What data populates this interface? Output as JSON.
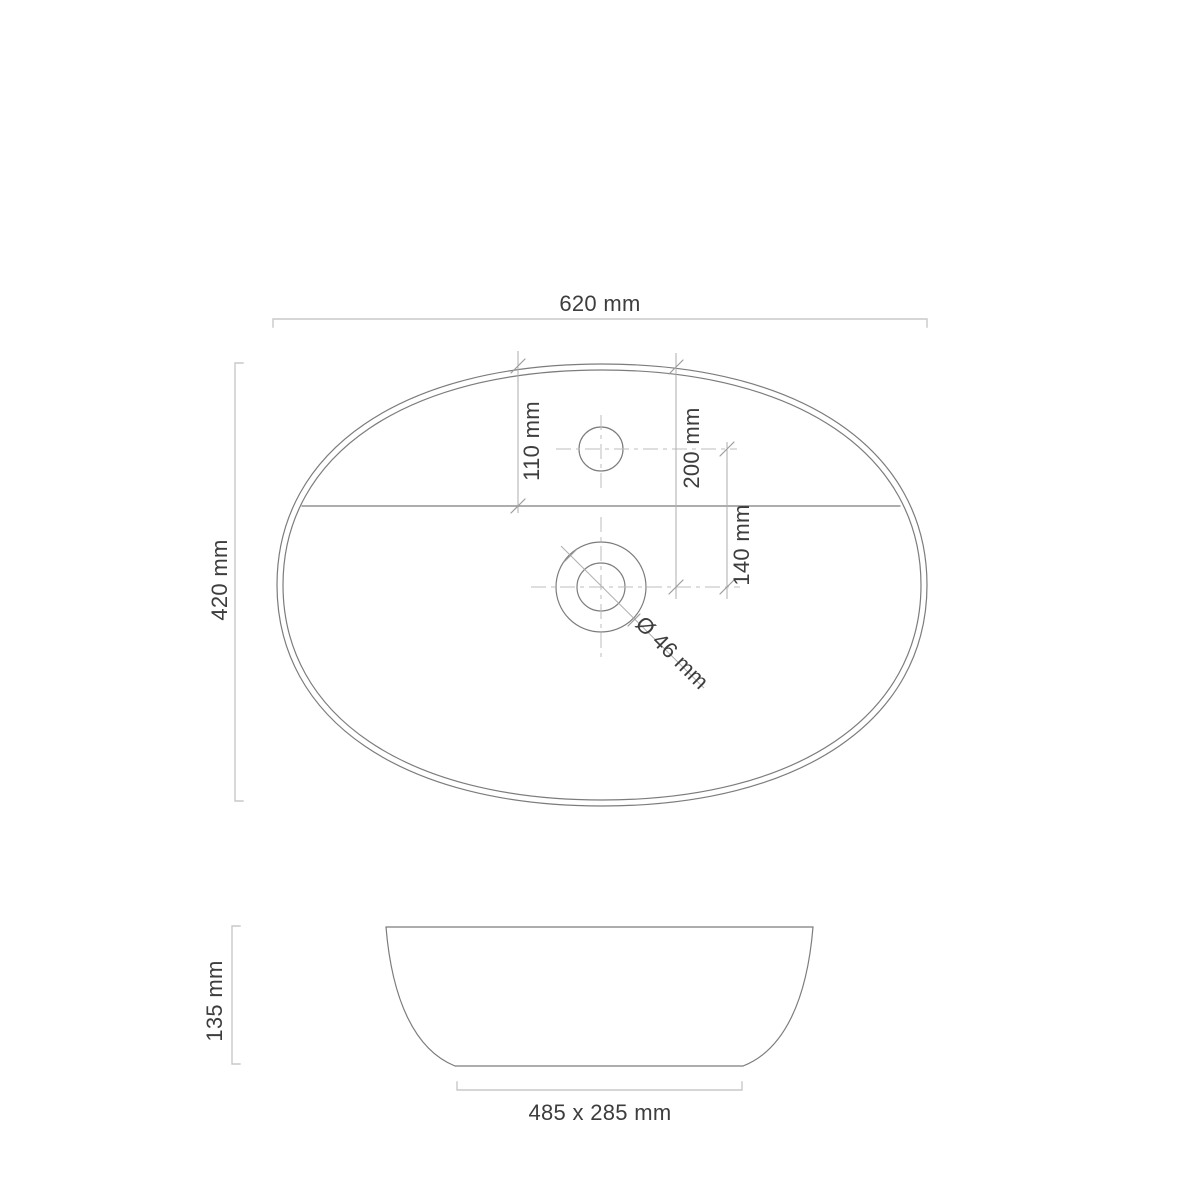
{
  "drawing": {
    "colors": {
      "background": "#ffffff",
      "outline": "#7c7c7c",
      "dimension_bracket": "#c9c9c9",
      "dimension_line": "#aeaeae",
      "tick": "#9c9c9c",
      "centerline": "#bcbcbc",
      "text": "#3d3d3d"
    },
    "top_view": {
      "width": "620 mm",
      "depth": "420 mm",
      "tap_hole_offset": "110 mm",
      "drain_offset": "200 mm",
      "tap_to_drain_distance": "140 mm",
      "drain_diameter": "Ø 46 mm"
    },
    "front_view": {
      "height": "135 mm",
      "base": "485 x 285 mm"
    }
  }
}
